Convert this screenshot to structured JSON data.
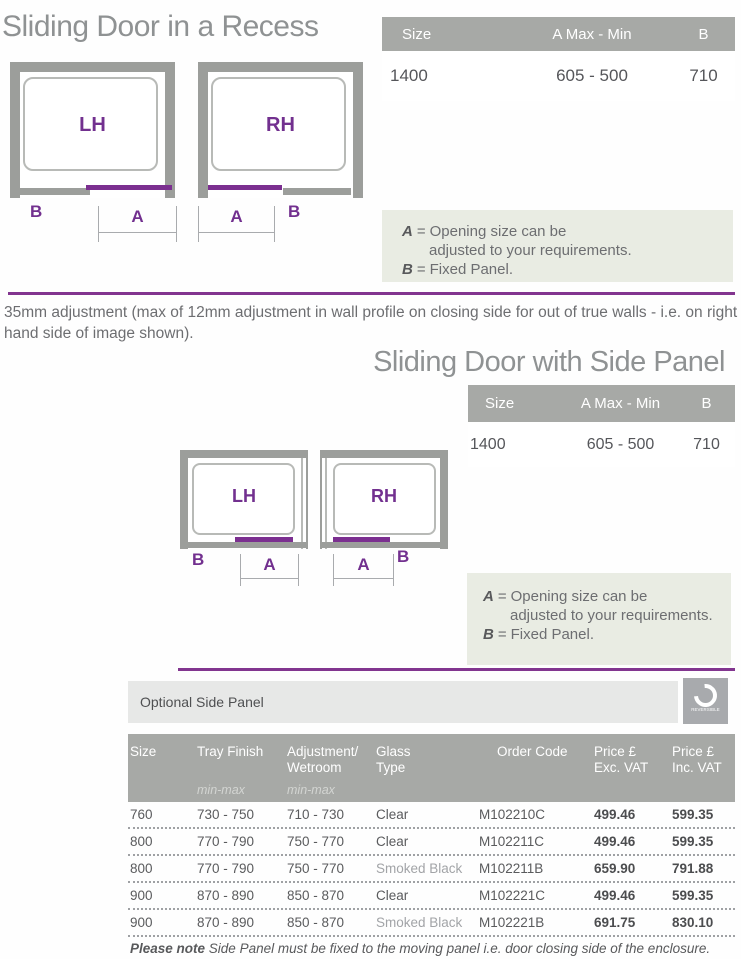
{
  "colors": {
    "purple_accent": "#7b2f90",
    "purple_line": "#82358f",
    "header_gray": "#a7a9a6",
    "note_box_bg": "#e9ece3",
    "optional_bar_bg": "#e7e8e7",
    "diagram_wall_gray": "#9c9e9b",
    "title_gray": "#8f9293",
    "text_dark": "#58595b",
    "text_gray": "#6d6e71",
    "smoked_text": "#a2a4a7"
  },
  "diagram_labels": {
    "lh": "LH",
    "rh": "RH",
    "a": "A",
    "b": "B"
  },
  "note_box": {
    "a_key": "A",
    "eq": "=",
    "a_line1": "Opening size can be",
    "a_line2": "adjusted to your requirements.",
    "b_key": "B",
    "b_text": "Fixed Panel."
  },
  "section_recess": {
    "title": "Sliding Door in a Recess",
    "size_table": {
      "col_size": "Size",
      "col_a": "A Max - Min",
      "col_b": "B",
      "row": {
        "size": "1400",
        "a": "605 - 500",
        "b": "710"
      }
    },
    "adjustment_note": "35mm adjustment (max of 12mm adjustment in wall profile on closing side for out of true walls - i.e. on right hand side of image shown)."
  },
  "section_side_panel": {
    "title": "Sliding Door with Side Panel",
    "size_table": {
      "col_size": "Size",
      "col_a": "A Max - Min",
      "col_b": "B",
      "row": {
        "size": "1400",
        "a": "605 - 500",
        "b": "710"
      }
    }
  },
  "optional_panel": {
    "bar_title": "Optional Side Panel",
    "reversible_label": "REVERSIBLE",
    "table": {
      "col_size": "Size",
      "col_tray": "Tray Finish",
      "col_adj_l1": "Adjustment/",
      "col_adj_l2": "Wetroom",
      "col_glass_l1": "Glass",
      "col_glass_l2": "Type",
      "col_code": "Order Code",
      "col_price_l1": "Price £",
      "col_price_exc_l2": "Exc. VAT",
      "col_price_inc_l2": "Inc. VAT",
      "sub_minmax": "min-max",
      "rows": [
        {
          "size": "760",
          "tray": "730 - 750",
          "adj": "710 - 730",
          "glass": "Clear",
          "code": "M102210C",
          "exc": "499.46",
          "inc": "599.35"
        },
        {
          "size": "800",
          "tray": "770 - 790",
          "adj": "750 - 770",
          "glass": "Clear",
          "code": "M102211C",
          "exc": "499.46",
          "inc": "599.35"
        },
        {
          "size": "800",
          "tray": "770 - 790",
          "adj": "750 - 770",
          "glass": "Smoked Black",
          "code": "M102211B",
          "exc": "659.90",
          "inc": "791.88"
        },
        {
          "size": "900",
          "tray": "870 - 890",
          "adj": "850 - 870",
          "glass": "Clear",
          "code": "M102221C",
          "exc": "499.46",
          "inc": "599.35"
        },
        {
          "size": "900",
          "tray": "870 - 890",
          "adj": "850 - 870",
          "glass": "Smoked Black",
          "code": "M102221B",
          "exc": "691.75",
          "inc": "830.10"
        }
      ]
    },
    "footnote": {
      "bold": "Please note",
      "rest": " Side Panel must be fixed to the moving panel i.e. door closing side of the enclosure."
    }
  }
}
